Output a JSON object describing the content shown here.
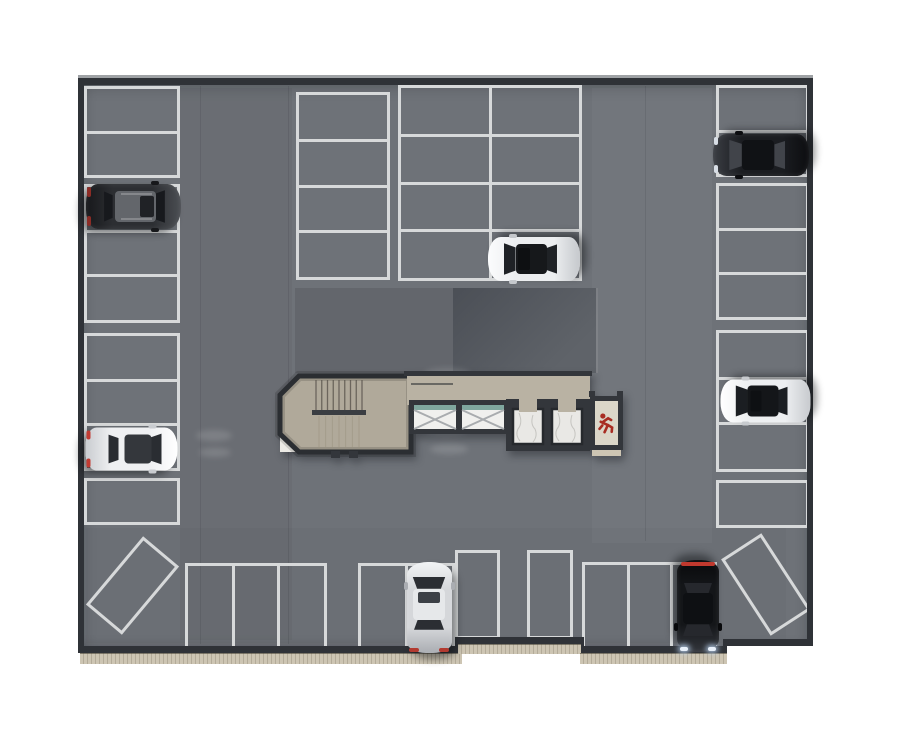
{
  "palette": {
    "floor": "#6e7278",
    "line": "#d7d9da",
    "wall": "#2f3237",
    "wallhi": "#9fa2a5",
    "curb": "#cdc5b3",
    "curbdot": "#b3ab99",
    "shadow_a": "#63666c",
    "shadow_b_dark": "#4b4f56",
    "shadow_b_light": "#5f6369",
    "core_wall": "#33363b",
    "stair_floor": "#b0a99a",
    "corridor_floor": "#b9b2a3",
    "elevator_marble": "#e9e8e5",
    "marble_vein": "#c6c5c1",
    "xbox_fill": "#f0f0ee",
    "xbox_line": "#a9acaf",
    "glass_teal": "#7fa79e",
    "exit_floor": "#dbd6c8",
    "exit_icon_red": "#a82c22",
    "tread_line": "#5a554d",
    "white_corner": "#eceae5"
  },
  "garage": {
    "floor_poly": [
      [
        78,
        78
      ],
      [
        813,
        78
      ],
      [
        813,
        643
      ],
      [
        725,
        643
      ],
      [
        725,
        650
      ],
      [
        580,
        650
      ],
      [
        580,
        641
      ],
      [
        458,
        641
      ],
      [
        458,
        650
      ],
      [
        78,
        650
      ]
    ]
  },
  "walls": [
    {
      "x": 78,
      "y": 75,
      "w": 735,
      "h": 3,
      "hi": true
    },
    {
      "x": 78,
      "y": 78,
      "w": 735,
      "h": 7
    },
    {
      "x": 78,
      "y": 78,
      "w": 6,
      "h": 575
    },
    {
      "x": 807,
      "y": 78,
      "w": 6,
      "h": 568
    },
    {
      "x": 78,
      "y": 646,
      "w": 383,
      "h": 7
    },
    {
      "x": 455,
      "y": 637,
      "w": 7,
      "h": 16
    },
    {
      "x": 455,
      "y": 637,
      "w": 128,
      "h": 7
    },
    {
      "x": 578,
      "y": 637,
      "w": 6,
      "h": 16
    },
    {
      "x": 578,
      "y": 646,
      "w": 149,
      "h": 7
    },
    {
      "x": 723,
      "y": 639,
      "w": 4,
      "h": 14
    },
    {
      "x": 723,
      "y": 639,
      "w": 90,
      "h": 7
    }
  ],
  "curbs": [
    {
      "x": 80,
      "y": 653,
      "w": 382,
      "h": 10
    },
    {
      "x": 458,
      "y": 644,
      "w": 123,
      "h": 9
    },
    {
      "x": 580,
      "y": 653,
      "w": 147,
      "h": 10
    }
  ],
  "shadow_zones": [
    {
      "x": 295,
      "y": 288,
      "w": 158,
      "h": 85,
      "kind": "flat"
    },
    {
      "x": 453,
      "y": 288,
      "w": 145,
      "h": 85,
      "kind": "grad"
    },
    {
      "x": 596,
      "y": 288,
      "w": 2,
      "h": 85,
      "kind": "edge"
    }
  ],
  "floor_patches": [
    {
      "x": 180,
      "y": 88,
      "w": 112,
      "h": 552,
      "c": "rgba(0,0,0,0.035)"
    },
    {
      "x": 592,
      "y": 88,
      "w": 120,
      "h": 455,
      "c": "rgba(255,255,255,0.03)"
    },
    {
      "x": 86,
      "y": 528,
      "w": 700,
      "h": 115,
      "c": "rgba(0,0,0,0.02)"
    }
  ],
  "floor_seams": [
    {
      "x": 200,
      "y": 86,
      "h": 558
    },
    {
      "x": 288,
      "y": 86,
      "h": 558
    },
    {
      "x": 645,
      "y": 86,
      "h": 455
    }
  ],
  "tire_smudges": [
    {
      "x": 196,
      "y": 430,
      "w": 36,
      "h": 11
    },
    {
      "x": 199,
      "y": 448,
      "w": 32,
      "h": 9
    },
    {
      "x": 424,
      "y": 368,
      "w": 46,
      "h": 12
    },
    {
      "x": 420,
      "y": 388,
      "w": 40,
      "h": 10
    },
    {
      "x": 424,
      "y": 424,
      "w": 44,
      "h": 12
    },
    {
      "x": 430,
      "y": 444,
      "w": 38,
      "h": 10
    }
  ],
  "parking_groups": [
    {
      "id": "L1",
      "x": 84,
      "y": 86,
      "w": 96,
      "h": 92,
      "cells": 2,
      "axis": "col"
    },
    {
      "id": "L2",
      "x": 84,
      "y": 184,
      "w": 96,
      "h": 139,
      "cells": 3,
      "axis": "col"
    },
    {
      "id": "L3",
      "x": 84,
      "y": 333,
      "w": 96,
      "h": 138,
      "cells": 3,
      "axis": "col"
    },
    {
      "id": "L4",
      "x": 84,
      "y": 478,
      "w": 96,
      "h": 47,
      "cells": 1,
      "axis": "col"
    },
    {
      "id": "M1",
      "x": 296,
      "y": 92,
      "w": 94,
      "h": 188,
      "cells": 4,
      "axis": "col"
    },
    {
      "id": "M2",
      "x": 398,
      "y": 85,
      "w": 184,
      "h": 196,
      "cells": 4,
      "axis": "col",
      "cols": 2
    },
    {
      "id": "R1",
      "x": 716,
      "y": 85,
      "w": 93,
      "h": 92,
      "cells": 2,
      "axis": "col"
    },
    {
      "id": "R2",
      "x": 716,
      "y": 183,
      "w": 93,
      "h": 137,
      "cells": 3,
      "axis": "col"
    },
    {
      "id": "R3",
      "x": 716,
      "y": 330,
      "w": 93,
      "h": 142,
      "cells": 3,
      "axis": "col"
    },
    {
      "id": "R4",
      "x": 716,
      "y": 480,
      "w": 93,
      "h": 48,
      "cells": 1,
      "axis": "col"
    },
    {
      "id": "B1",
      "x": 185,
      "y": 563,
      "w": 142,
      "h": 90,
      "cells": 3,
      "axis": "row"
    },
    {
      "id": "B2",
      "x": 358,
      "y": 563,
      "w": 97,
      "h": 90,
      "cells": 2,
      "axis": "row"
    },
    {
      "id": "B2b",
      "x": 455,
      "y": 550,
      "w": 45,
      "h": 89,
      "cells": 1,
      "axis": "row"
    },
    {
      "id": "B3a",
      "x": 527,
      "y": 550,
      "w": 46,
      "h": 89,
      "cells": 1,
      "axis": "row"
    },
    {
      "id": "B3b",
      "x": 582,
      "y": 562,
      "w": 135,
      "h": 91,
      "cells": 3,
      "axis": "row"
    }
  ],
  "diagonal_spaces": [
    {
      "id": "D1",
      "cx": 132,
      "cy": 585,
      "w": 47,
      "h": 89,
      "rot": 40
    },
    {
      "id": "D2",
      "cx": 766,
      "cy": 584,
      "w": 48,
      "h": 91,
      "rot": -33
    }
  ],
  "core": {
    "x": 268,
    "y": 362,
    "w": 364,
    "h": 110,
    "stair_poly": [
      [
        299,
        376
      ],
      [
        411,
        376
      ],
      [
        411,
        452
      ],
      [
        299,
        452
      ],
      [
        280,
        434
      ],
      [
        280,
        395
      ]
    ],
    "white_corner": [
      [
        280,
        436
      ],
      [
        296,
        452
      ],
      [
        280,
        452
      ]
    ],
    "treads_upper": {
      "x1": 316,
      "x2": 362,
      "n": 9,
      "y1": 380,
      "y2": 411
    },
    "landing": {
      "x": 312,
      "y": 410,
      "w": 54,
      "h": 5
    },
    "treads_lower": {
      "x1": 319,
      "x2": 359,
      "n": 7,
      "y1": 416,
      "y2": 448
    },
    "door_stubs": [
      {
        "x": 331,
        "y": 451,
        "w": 9,
        "h": 7
      },
      {
        "x": 349,
        "y": 451,
        "w": 9,
        "h": 7
      }
    ],
    "corridor": {
      "x": 407,
      "y": 374,
      "w": 183,
      "h": 31
    },
    "corridor_top_wall": {
      "x": 404,
      "y": 371,
      "w": 188,
      "h": 5
    },
    "corridor_rail": {
      "x": 411,
      "y": 383,
      "w": 42,
      "h": 2
    },
    "xbox_outer": {
      "x": 409,
      "y": 400,
      "w": 101,
      "h": 34
    },
    "xboxes": [
      {
        "x": 414,
        "y": 405,
        "w": 42,
        "h": 24
      },
      {
        "x": 462,
        "y": 405,
        "w": 42,
        "h": 24
      }
    ],
    "elev_block": {
      "x": 506,
      "y": 399,
      "w": 84,
      "h": 52
    },
    "cabins": [
      {
        "x": 513,
        "y": 409,
        "w": 30,
        "h": 35
      },
      {
        "x": 552,
        "y": 409,
        "w": 30,
        "h": 35
      }
    ],
    "doors": [
      {
        "x": 519,
        "y": 399,
        "w": 18,
        "h": 13
      },
      {
        "x": 558,
        "y": 399,
        "w": 18,
        "h": 13
      }
    ],
    "exit_shaft": {
      "x": 590,
      "y": 396,
      "w": 33,
      "h": 54
    },
    "exit_interior": {
      "x": 595,
      "y": 401,
      "w": 23,
      "h": 44
    },
    "exit_strip": {
      "x": 592,
      "y": 450,
      "w": 29,
      "h": 6
    },
    "top_stubs": [
      {
        "x": 589,
        "y": 391,
        "w": 6,
        "h": 6
      },
      {
        "x": 617,
        "y": 391,
        "w": 6,
        "h": 6
      }
    ],
    "exit_icon": {
      "cx": 606,
      "cy": 424
    }
  },
  "cars": [
    {
      "id": "car-dark-gray-suv",
      "cx": 133,
      "cy": 206,
      "w": 45,
      "h": 95,
      "rot": 90,
      "type": "suv",
      "body": "#2c2e32",
      "hi": "#4b4e53",
      "dk": "#17181b",
      "glass": "#17191d",
      "roof": "#63666b",
      "sunroof": "#202226",
      "tail": "dots",
      "accent": "#8c2c26",
      "rails": true
    },
    {
      "id": "car-white-sports",
      "cx": 131,
      "cy": 449,
      "w": 43,
      "h": 92,
      "rot": 90,
      "type": "sport",
      "body": "#eff0f2",
      "hi": "#ffffff",
      "dk": "#c9ccd0",
      "glass": "#2a2d32",
      "roof": "#34373c",
      "tail": "dots",
      "accent": "#c23b32"
    },
    {
      "id": "car-white-black-roof-center",
      "cx": 534,
      "cy": 259,
      "w": 44,
      "h": 92,
      "rot": -90,
      "type": "sedan",
      "body": "#eceef0",
      "hi": "#fbfcfd",
      "dk": "#c5c8cc",
      "glass": "#1f2226",
      "roof": "#16181b",
      "sunroof": "#0e1012"
    },
    {
      "id": "car-black-sedan-right",
      "cx": 761,
      "cy": 155,
      "w": 42,
      "h": 96,
      "rot": -90,
      "type": "sedan",
      "body": "#1b1d21",
      "hi": "#3a3d43",
      "dk": "#0c0d10",
      "glass": "#41444a",
      "roof": "#101215",
      "head": "dots"
    },
    {
      "id": "car-white-black-roof-right",
      "cx": 765,
      "cy": 401,
      "w": 43,
      "h": 90,
      "rot": -90,
      "type": "sedan",
      "body": "#edeff1",
      "hi": "#ffffff",
      "dk": "#c7cace",
      "glass": "#1b1e22",
      "roof": "#141619",
      "sunroof": "#0e1013"
    },
    {
      "id": "car-silver-bottom",
      "cx": 429,
      "cy": 607,
      "w": 45,
      "h": 91,
      "rot": 0,
      "type": "sedan",
      "body": "#d5d7da",
      "hi": "#f2f4f6",
      "dk": "#aaadb2",
      "glass": "#2b2e33",
      "roof": "#e6e8ea",
      "sunroof": "#3c4046",
      "tail": "dots",
      "accent": "#b23a30"
    },
    {
      "id": "car-black-bottom",
      "cx": 698,
      "cy": 606,
      "w": 42,
      "h": 92,
      "rot": 180,
      "type": "sedan",
      "body": "#141619",
      "hi": "#33363c",
      "dk": "#08090b",
      "glass": "#26282d",
      "roof": "#0e1013",
      "tail": "strip",
      "accent": "#c0392e",
      "head": "glow"
    }
  ]
}
